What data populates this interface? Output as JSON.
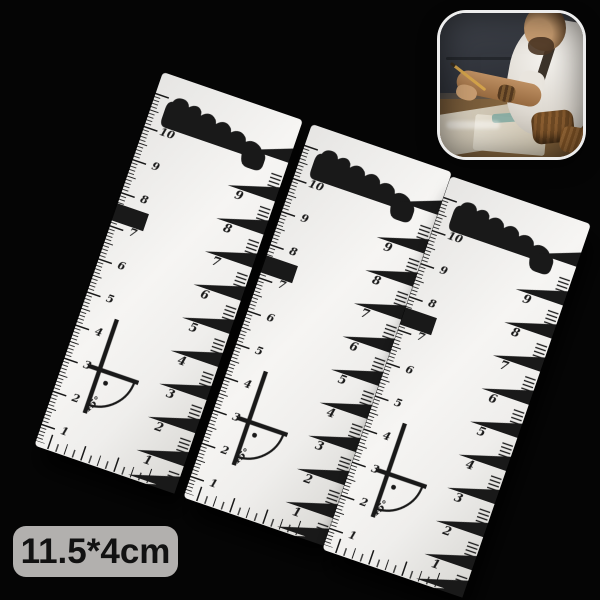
{
  "size_label": {
    "text": "11.5*4cm"
  },
  "ruler": {
    "left_scale": [
      10,
      9,
      8,
      7,
      6,
      5,
      4,
      3,
      2,
      1
    ],
    "right_scale": [
      10,
      9,
      8,
      7,
      6,
      5,
      4,
      3,
      2,
      1
    ],
    "angle_label": "45°"
  },
  "rulers": [
    {
      "x": 163,
      "y": 72,
      "rotation": 19
    },
    {
      "x": 312,
      "y": 124,
      "rotation": 19
    },
    {
      "x": 451,
      "y": 176,
      "rotation": 19
    }
  ],
  "css_vars": {
    "--bg": "#050505",
    "--ink": "#191919",
    "--ruler-body": "#f2f1ef",
    "--label-bg": "#b2b0ae",
    "--label-fg": "#121212",
    "--photo-border": "#ededed",
    "--c-couch": "#42464e",
    "--c-shirt": "#f4f2ee",
    "--c-skin": "#bd8f62",
    "--c-skin2": "#c79c70",
    "--c-hair": "#5d4228",
    "--c-leather": "#6f4a24",
    "--c-paper": "#d9d1c1",
    "--c-pencil": "#d2a24a"
  }
}
